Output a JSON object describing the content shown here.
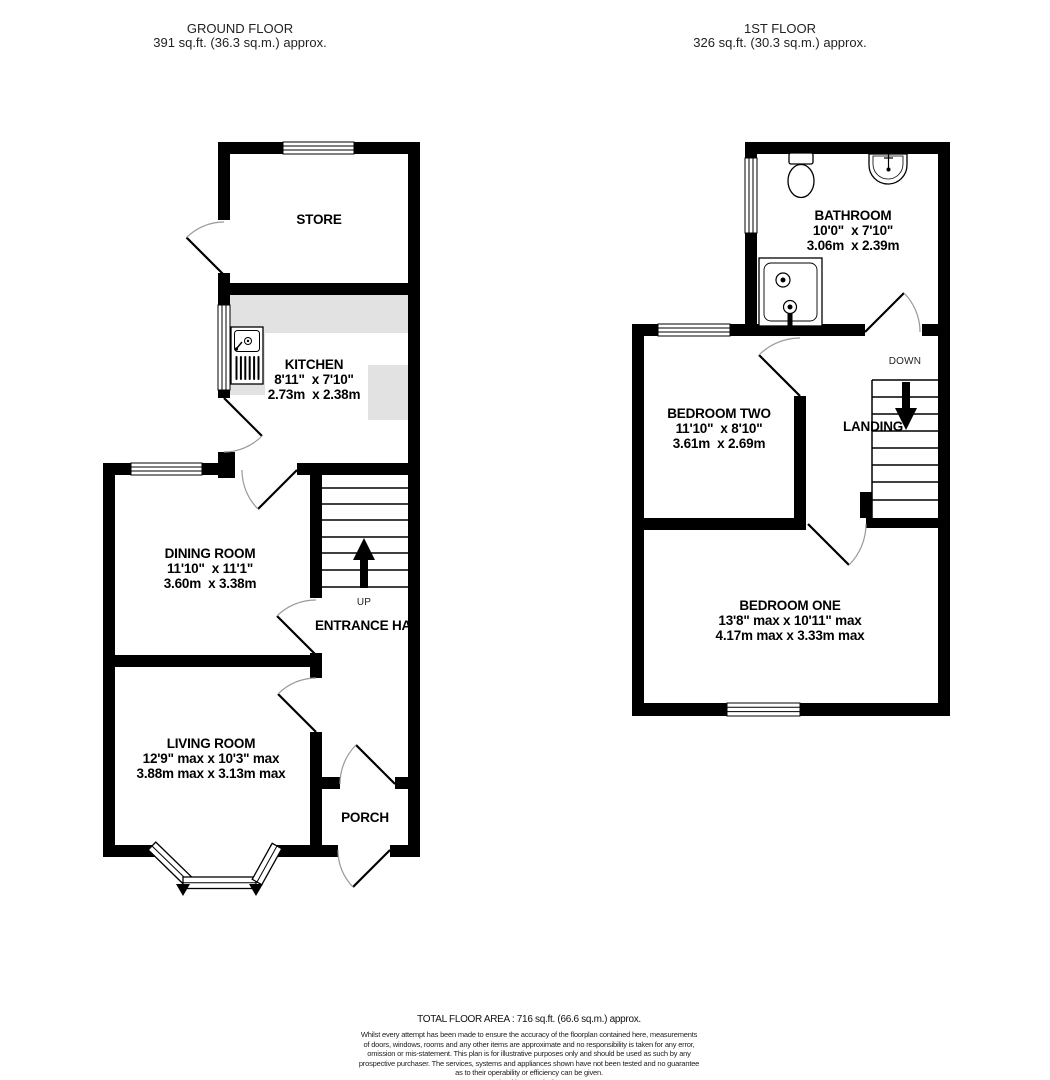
{
  "ground_floor": {
    "title": "GROUND FLOOR",
    "area": "391 sq.ft. (36.3 sq.m.) approx.",
    "store": {
      "name": "STORE"
    },
    "kitchen": {
      "name": "KITCHEN",
      "imperial": "8'11\"  x 7'10\"",
      "metric": "2.73m  x 2.38m"
    },
    "dining": {
      "name": "DINING ROOM",
      "imperial": "11'10\"  x 11'1\"",
      "metric": "3.60m  x 3.38m"
    },
    "living": {
      "name": "LIVING ROOM",
      "imperial": "12'9\" max x 10'3\" max",
      "metric": "3.88m max x 3.13m max"
    },
    "hall": {
      "name": "ENTRANCE HALL"
    },
    "porch": {
      "name": "PORCH"
    },
    "stairs_label": "UP"
  },
  "first_floor": {
    "title": "1ST FLOOR",
    "area": "326 sq.ft. (30.3 sq.m.) approx.",
    "bathroom": {
      "name": "BATHROOM",
      "imperial": "10'0\"  x 7'10\"",
      "metric": "3.06m  x 2.39m"
    },
    "bedroom_two": {
      "name": "BEDROOM TWO",
      "imperial": "11'10\"  x 8'10\"",
      "metric": "3.61m  x 2.69m"
    },
    "bedroom_one": {
      "name": "BEDROOM ONE",
      "imperial": "13'8\" max x 10'11\" max",
      "metric": "4.17m max x 3.33m max"
    },
    "landing": {
      "name": "LANDING"
    },
    "stairs_label": "DOWN"
  },
  "footer": {
    "total": "TOTAL FLOOR AREA : 716 sq.ft. (66.6 sq.m.) approx.",
    "disclaimer": "Whilst every attempt has been made to ensure the accuracy of the floorplan contained here, measurements\nof doors, windows, rooms and any other items are approximate and no responsibility is taken for any error,\nomission or mis-statement. This plan is for illustrative purposes only and should be used as such by any\nprospective purchaser. The services, systems and appliances shown have not been tested and no guarantee\nas to their operability or efficiency can be given.\nMade with Metropix ©2024"
  },
  "colors": {
    "wall": "#000000",
    "counter": "#e2e2e2",
    "door_arc": "#999999"
  }
}
